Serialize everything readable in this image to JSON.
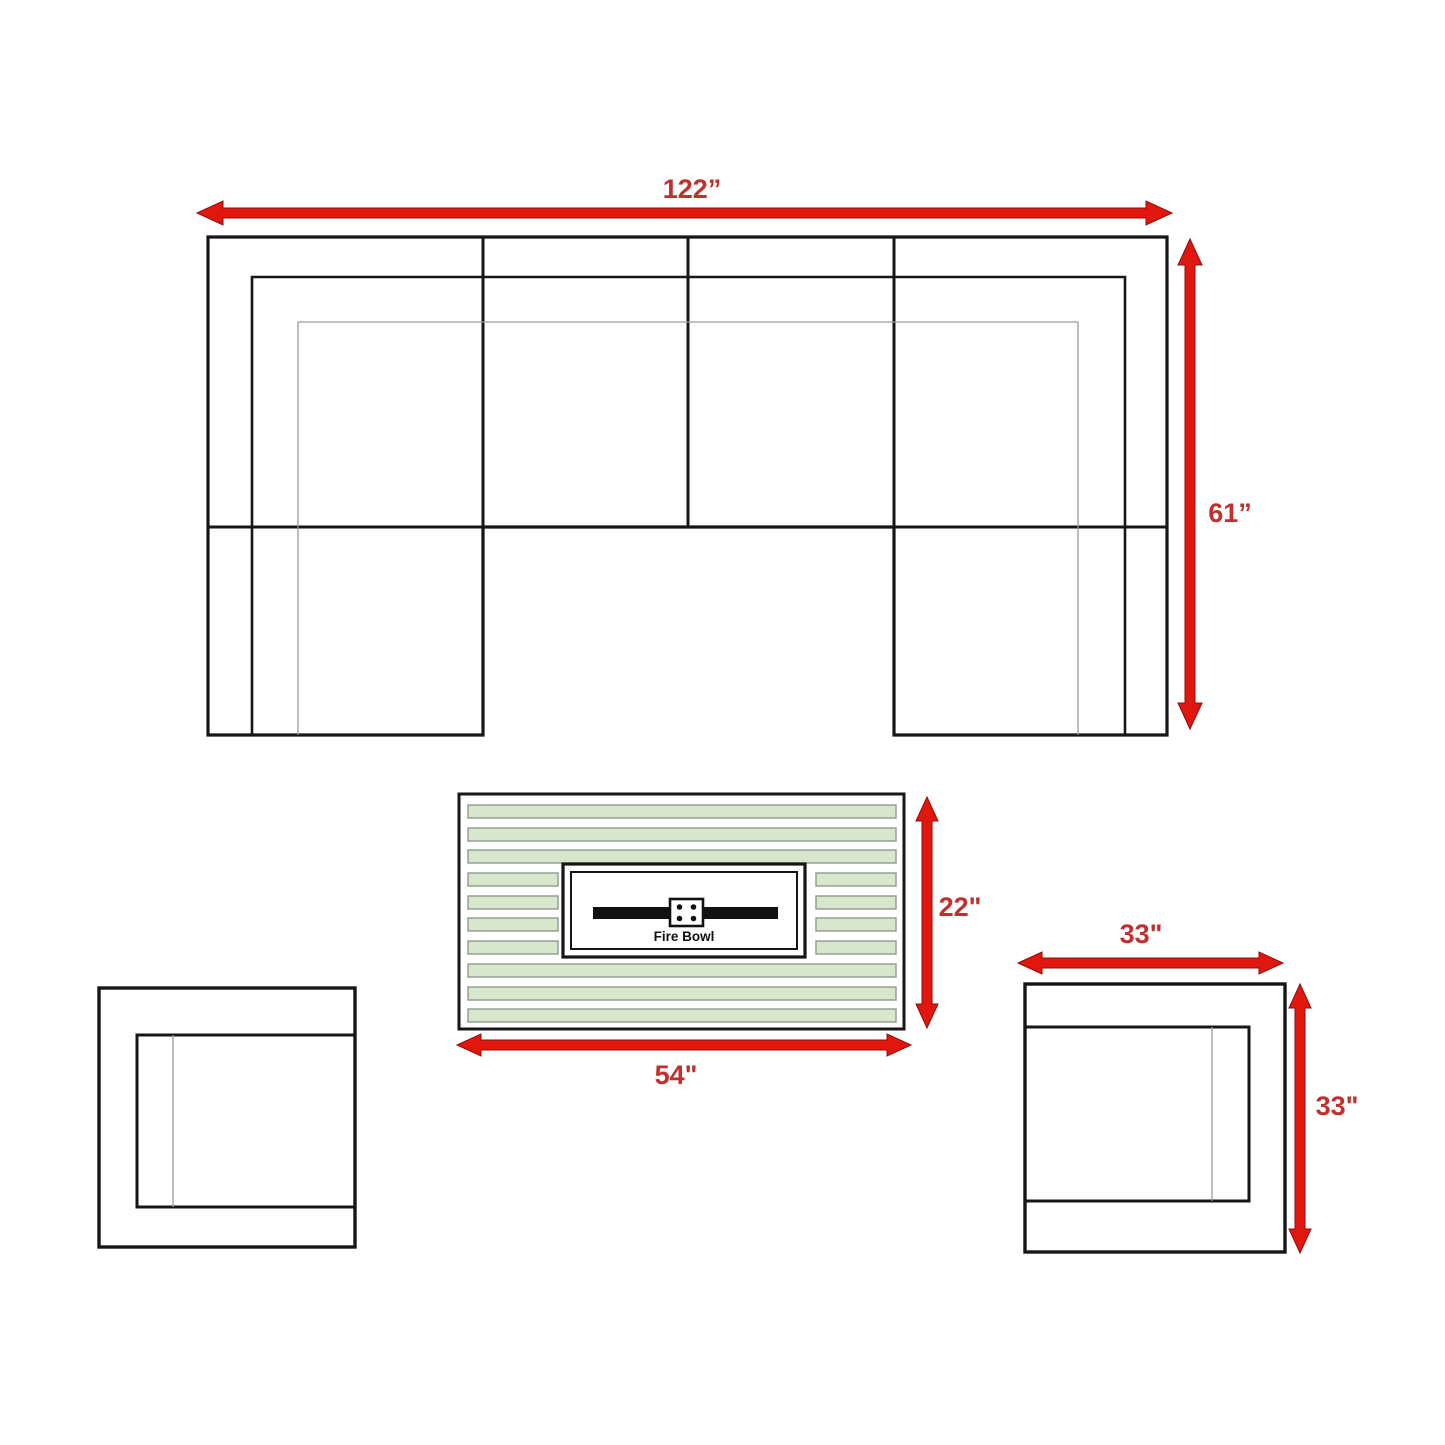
{
  "colors": {
    "background": "#ffffff",
    "outline": "#161616",
    "thin_line": "#9a9a9a",
    "arrow_red": "#e1170e",
    "arrow_edge": "#8e0e0a",
    "label_red": "#c22f2f",
    "slat_green": "#d8e7cc",
    "slat_border": "#93a193",
    "panel_white": "#ffffff",
    "burner_black": "#111111"
  },
  "sectional": {
    "width_label": "122”",
    "depth_label": "61”"
  },
  "fire_table": {
    "label": "Fire Bowl",
    "depth_label": "22\"",
    "width_label": "54\""
  },
  "right_chair": {
    "width_label": "33\"",
    "depth_label": "33\""
  }
}
